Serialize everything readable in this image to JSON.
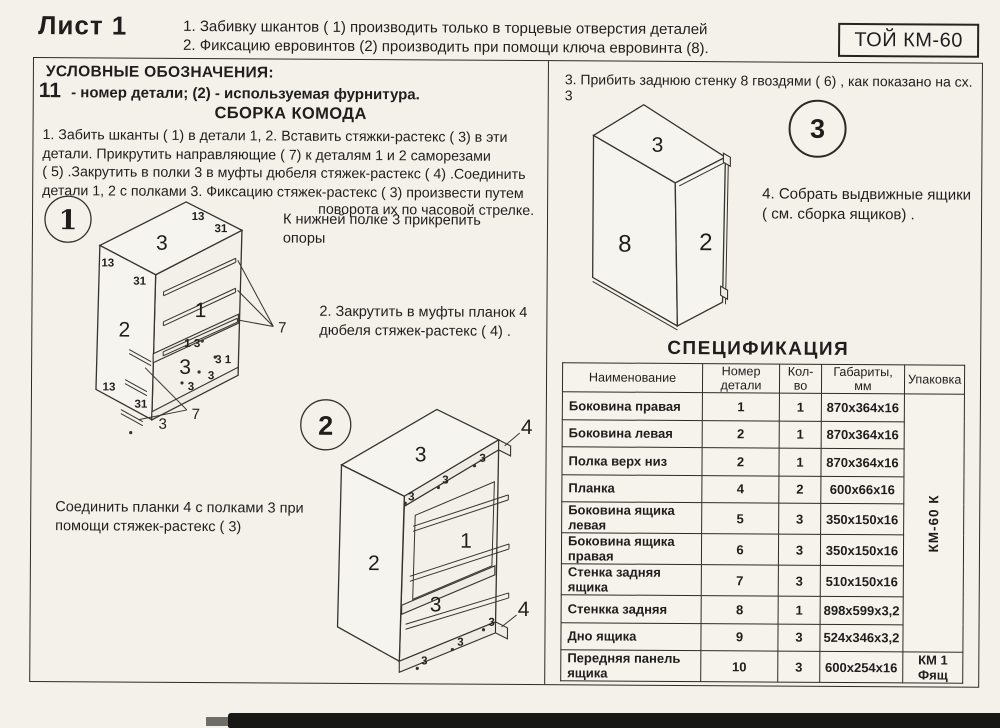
{
  "page": {
    "sheet_label": "Лист 1",
    "model_code": "ТОЙ КМ-60",
    "top_notes": "1. Забивку шкантов  ( 1)   производить только в торцевые отверстия деталей\n2. Фиксацию евровинтов (2) производить при помощи ключа евровинта (8)."
  },
  "legend": {
    "title": "УСЛОВНЫЕ ОБОЗНАЧЕНИЯ:",
    "part_symbol": "11",
    "text": "- номер детали;  (2) - используемая фурнитура."
  },
  "assembly": {
    "title": "СБОРКА КОМОДА",
    "step1": "1. Забить шканты  ( 1)   в детали 1, 2. Вставить стяжки-растекс  ( 3)   в эти\nдетали. Прикрутить направляющие  ( 7)   к деталям  1 и 2 саморезами\n( 5)  .Закрутить в полки 3 в муфты дюбеля стяжек-растекс  ( 4)  .Соединить\nдетали 1, 2 с полками 3. Фиксацию стяжек-растекс  ( 3)   произвести путем",
    "step1_end": "поворота их по часовой стрелке.",
    "note_support": "К нижней полке 3 прикрепить\nопоры",
    "step2": "2. Закрутить в муфты планок 4\nдюбеля стяжек-растекс  ( 4)  .",
    "note_join": "Соединить планки 4 с полками 3 при\nпомощи стяжек-растекс   ( 3)",
    "step3": "3. Прибить заднюю стенку 8 гвоздями   ( 6)   , как показано на сх. 3",
    "step4": "4. Собрать выдвижные ящики\n( см. сборка ящиков)   ."
  },
  "diagrams": {
    "d1": {
      "badge": "1",
      "part_top": "3",
      "part_left": "2",
      "part_back": "1",
      "part_shelf": "3",
      "part_bottom": "3",
      "rail_label": "7",
      "rail_label2": "7",
      "m1": "13",
      "m2": "31",
      "m3": "13",
      "m4": "31",
      "m5": "13",
      "m6": "31",
      "m7": "1 3",
      "m8": "3 1",
      "m9": "3",
      "m10": "3"
    },
    "d2": {
      "badge": "2",
      "part_top": "3",
      "part_left": "2",
      "part_back": "1",
      "part_shelf": "3",
      "plank_top": "4",
      "plank_bottom": "4",
      "m1": "3",
      "m2": "3",
      "m3": "3",
      "m4": "3",
      "m5": "3",
      "m6": "3"
    },
    "d3": {
      "badge": "3",
      "part_top": "3",
      "part_back": "8",
      "part_side": "2"
    }
  },
  "spec": {
    "title": "СПЕЦИФИКАЦИЯ",
    "columns": [
      "Наименование",
      "Номер детали",
      "Кол-во",
      "Габариты, мм",
      "Упаковка"
    ],
    "rows": [
      {
        "name": "Боковина правая",
        "num": "1",
        "qty": "1",
        "size": "870х364х16"
      },
      {
        "name": "Боковина левая",
        "num": "2",
        "qty": "1",
        "size": "870х364х16"
      },
      {
        "name": "Полка верх низ",
        "num": "2",
        "qty": "1",
        "size": "870х364х16"
      },
      {
        "name": "Планка",
        "num": "4",
        "qty": "2",
        "size": "600х66х16"
      },
      {
        "name": "Боковина ящика левая",
        "num": "5",
        "qty": "3",
        "size": "350х150х16"
      },
      {
        "name": "Боковина ящика правая",
        "num": "6",
        "qty": "3",
        "size": "350х150х16"
      },
      {
        "name": "Стенка задняя ящика",
        "num": "7",
        "qty": "3",
        "size": "510х150х16"
      },
      {
        "name": "Стенкка задняя",
        "num": "8",
        "qty": "1",
        "size": "898х599х3,2"
      },
      {
        "name": "Дно ящика",
        "num": "9",
        "qty": "3",
        "size": "524х346х3,2"
      },
      {
        "name": "Передняя панель ящика",
        "num": "10",
        "qty": "3",
        "size": "600х254х16"
      }
    ],
    "package_vertical": "КМ-60 К",
    "package_last": "КМ 1 Фящ"
  }
}
